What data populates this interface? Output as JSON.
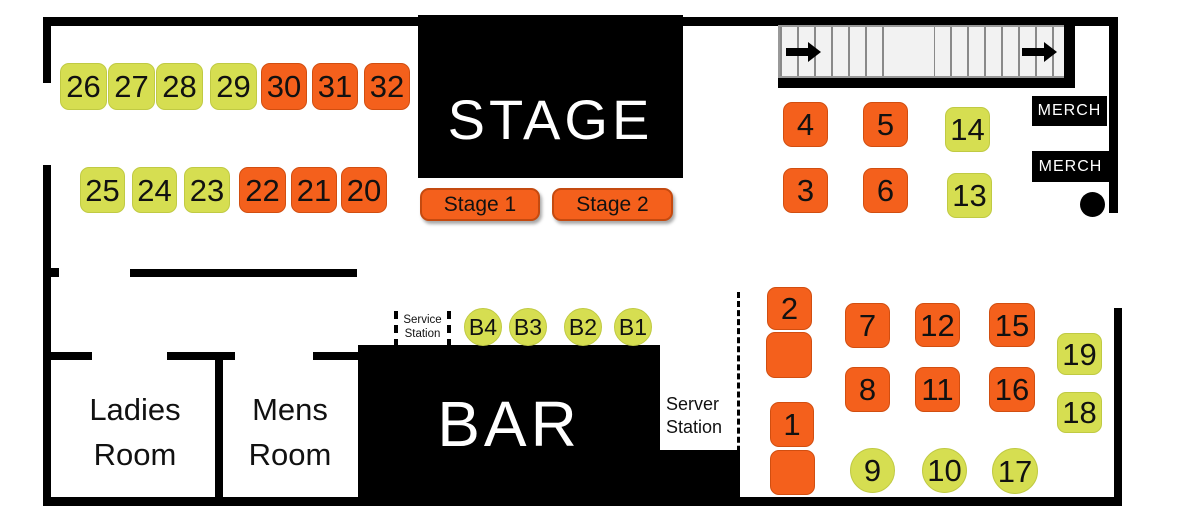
{
  "colors": {
    "table_orange": "#F4601C",
    "table_green": "#D6DE51",
    "wall_black": "#000000",
    "stairs_fill": "#F2F2F2",
    "text_light": "#FFFFFF",
    "text_dark": "#111111"
  },
  "stage": {
    "label": "STAGE",
    "zones": [
      {
        "label": "Stage 1"
      },
      {
        "label": "Stage 2"
      }
    ]
  },
  "bar": {
    "label": "BAR"
  },
  "merch": [
    {
      "label": "MERCH"
    },
    {
      "label": "MERCH"
    }
  ],
  "rooms": [
    {
      "lines": [
        "Ladies",
        "Room"
      ]
    },
    {
      "lines": [
        "Mens",
        "Room"
      ]
    }
  ],
  "stations": {
    "service": {
      "lines": [
        "Service",
        "Station"
      ]
    },
    "server": {
      "lines": [
        "Server",
        "Station"
      ]
    }
  },
  "tables": [
    {
      "label": "26",
      "shape": "square",
      "color": "green",
      "x": 60,
      "y": 63,
      "w": 47,
      "h": 47
    },
    {
      "label": "27",
      "shape": "square",
      "color": "green",
      "x": 108,
      "y": 63,
      "w": 47,
      "h": 47
    },
    {
      "label": "28",
      "shape": "square",
      "color": "green",
      "x": 156,
      "y": 63,
      "w": 47,
      "h": 47
    },
    {
      "label": "29",
      "shape": "square",
      "color": "green",
      "x": 210,
      "y": 63,
      "w": 47,
      "h": 47
    },
    {
      "label": "30",
      "shape": "square",
      "color": "orange",
      "x": 261,
      "y": 63,
      "w": 46,
      "h": 47
    },
    {
      "label": "31",
      "shape": "square",
      "color": "orange",
      "x": 312,
      "y": 63,
      "w": 46,
      "h": 47
    },
    {
      "label": "32",
      "shape": "square",
      "color": "orange",
      "x": 364,
      "y": 63,
      "w": 46,
      "h": 47
    },
    {
      "label": "25",
      "shape": "square",
      "color": "green",
      "x": 80,
      "y": 167,
      "w": 45,
      "h": 46
    },
    {
      "label": "24",
      "shape": "square",
      "color": "green",
      "x": 132,
      "y": 167,
      "w": 45,
      "h": 46
    },
    {
      "label": "23",
      "shape": "square",
      "color": "green",
      "x": 184,
      "y": 167,
      "w": 46,
      "h": 46
    },
    {
      "label": "22",
      "shape": "square",
      "color": "orange",
      "x": 239,
      "y": 167,
      "w": 47,
      "h": 46
    },
    {
      "label": "21",
      "shape": "square",
      "color": "orange",
      "x": 291,
      "y": 167,
      "w": 46,
      "h": 46
    },
    {
      "label": "20",
      "shape": "square",
      "color": "orange",
      "x": 341,
      "y": 167,
      "w": 46,
      "h": 46
    },
    {
      "label": "4",
      "shape": "square",
      "color": "orange",
      "x": 783,
      "y": 102,
      "w": 45,
      "h": 45
    },
    {
      "label": "5",
      "shape": "square",
      "color": "orange",
      "x": 863,
      "y": 102,
      "w": 45,
      "h": 45
    },
    {
      "label": "14",
      "shape": "square",
      "color": "green",
      "x": 945,
      "y": 107,
      "w": 45,
      "h": 45
    },
    {
      "label": "3",
      "shape": "square",
      "color": "orange",
      "x": 783,
      "y": 168,
      "w": 45,
      "h": 45
    },
    {
      "label": "6",
      "shape": "square",
      "color": "orange",
      "x": 863,
      "y": 168,
      "w": 45,
      "h": 45
    },
    {
      "label": "13",
      "shape": "square",
      "color": "green",
      "x": 947,
      "y": 173,
      "w": 45,
      "h": 45
    },
    {
      "label": "2",
      "shape": "square",
      "color": "orange",
      "x": 767,
      "y": 287,
      "w": 45,
      "h": 43
    },
    {
      "label": "",
      "shape": "square",
      "color": "orange",
      "x": 766,
      "y": 332,
      "w": 46,
      "h": 46
    },
    {
      "label": "7",
      "shape": "square",
      "color": "orange",
      "x": 845,
      "y": 303,
      "w": 45,
      "h": 45
    },
    {
      "label": "12",
      "shape": "square",
      "color": "orange",
      "x": 915,
      "y": 303,
      "w": 45,
      "h": 44
    },
    {
      "label": "15",
      "shape": "square",
      "color": "orange",
      "x": 989,
      "y": 303,
      "w": 46,
      "h": 44
    },
    {
      "label": "8",
      "shape": "square",
      "color": "orange",
      "x": 845,
      "y": 367,
      "w": 45,
      "h": 45
    },
    {
      "label": "11",
      "shape": "square",
      "color": "orange",
      "x": 915,
      "y": 367,
      "w": 45,
      "h": 45
    },
    {
      "label": "16",
      "shape": "square",
      "color": "orange",
      "x": 989,
      "y": 367,
      "w": 46,
      "h": 45
    },
    {
      "label": "19",
      "shape": "square",
      "color": "green",
      "x": 1057,
      "y": 333,
      "w": 45,
      "h": 42
    },
    {
      "label": "18",
      "shape": "square",
      "color": "green",
      "x": 1057,
      "y": 392,
      "w": 45,
      "h": 41
    },
    {
      "label": "1",
      "shape": "square",
      "color": "orange",
      "x": 770,
      "y": 402,
      "w": 44,
      "h": 45
    },
    {
      "label": "",
      "shape": "square",
      "color": "orange",
      "x": 770,
      "y": 450,
      "w": 45,
      "h": 45
    },
    {
      "label": "9",
      "shape": "circle",
      "color": "green",
      "x": 850,
      "y": 448,
      "w": 45,
      "h": 45
    },
    {
      "label": "10",
      "shape": "circle",
      "color": "green",
      "x": 922,
      "y": 448,
      "w": 45,
      "h": 45
    },
    {
      "label": "17",
      "shape": "circle",
      "color": "green",
      "x": 992,
      "y": 448,
      "w": 46,
      "h": 46
    },
    {
      "label": "B4",
      "shape": "circle",
      "color": "green",
      "x": 464,
      "y": 308,
      "w": 38,
      "h": 38
    },
    {
      "label": "B3",
      "shape": "circle",
      "color": "green",
      "x": 509,
      "y": 308,
      "w": 38,
      "h": 38
    },
    {
      "label": "B2",
      "shape": "circle",
      "color": "green",
      "x": 564,
      "y": 308,
      "w": 38,
      "h": 38
    },
    {
      "label": "B1",
      "shape": "circle",
      "color": "green",
      "x": 614,
      "y": 308,
      "w": 38,
      "h": 38
    }
  ]
}
